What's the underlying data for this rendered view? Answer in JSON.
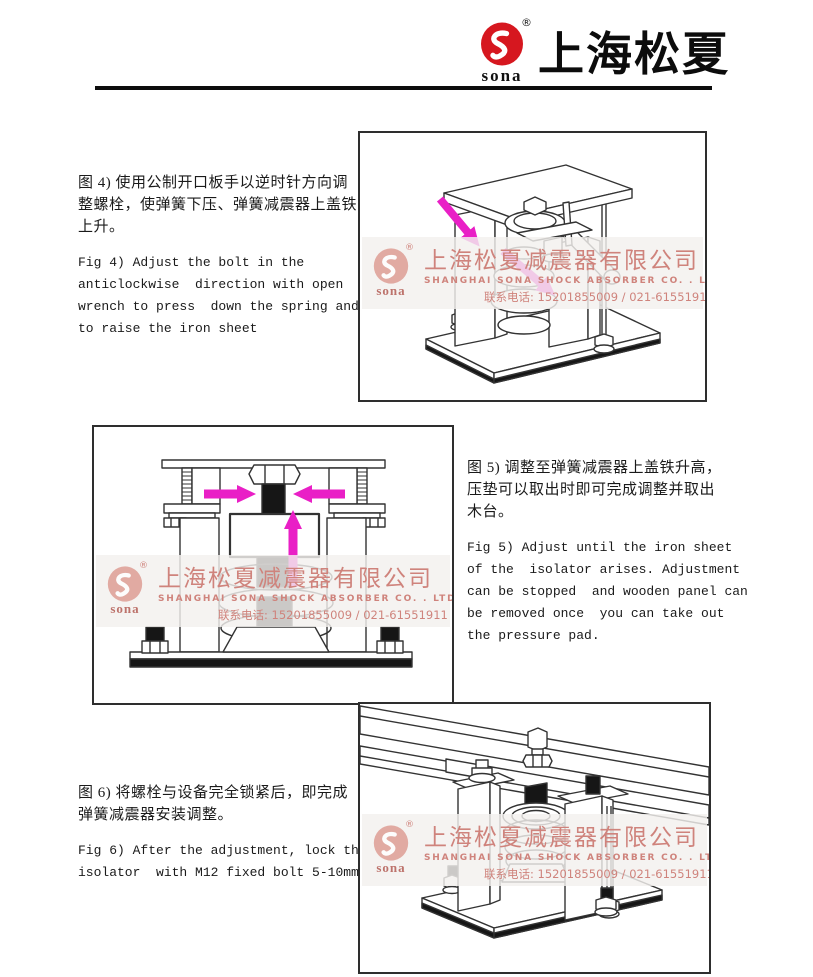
{
  "header": {
    "logo": {
      "text": "sona",
      "registered": "®"
    },
    "title": "上海松夏"
  },
  "watermark": {
    "logo_text": "sona",
    "registered": "®",
    "company_cn": "上海松夏减震器有限公司",
    "company_en": "SHANGHAI SONA SHOCK ABSORBER CO. . LTD",
    "phone": "联系电话: 15201855009 / 021-61551911"
  },
  "blocks": {
    "fig4": {
      "cn": "图 4) 使用公制开口板手以逆时针方向调\n整螺栓，使弹簧下压、弹簧减震器上盖铁\n上升。",
      "en": "Fig 4) Adjust the bolt in the\nanticlockwise  direction with open\nwrench to press  down the spring and\nto raise the iron sheet"
    },
    "fig5": {
      "cn": "图 5) 调整至弹簧减震器上盖铁升高，\n压垫可以取出时即可完成调整并取出\n木台。",
      "en": "Fig 5) Adjust until the iron sheet\nof the  isolator arises. Adjustment\ncan be stopped  and wooden panel can\nbe removed once  you can take out\nthe pressure pad."
    },
    "fig6": {
      "cn": "图 6) 将螺栓与设备完全锁紧后，即完成\n弹簧减震器安装调整。",
      "en": "Fig 6) After the adjustment, lock the\nisolator  with M12 fixed bolt 5-10mm"
    }
  },
  "colors": {
    "logo_red": "#d6171f",
    "wm_pink": "#cf837c",
    "arrow": "#e91fc6",
    "line": "#333333",
    "ink": "#1a1a1a"
  }
}
